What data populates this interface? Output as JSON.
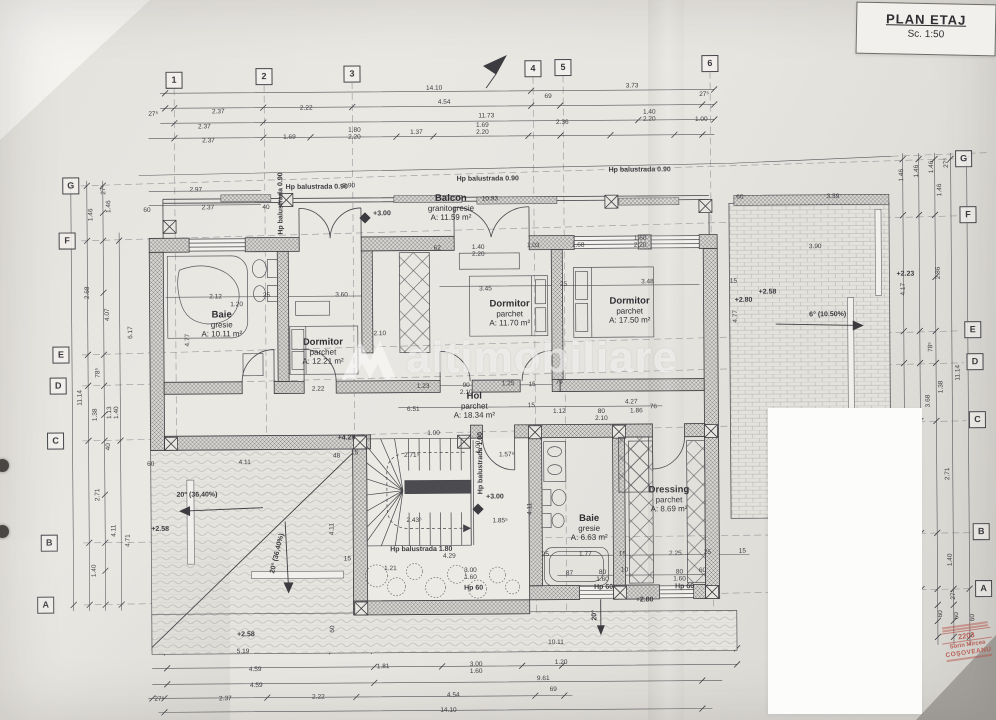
{
  "meta": {
    "title": "PLAN ETAJ",
    "scale": "Sc. 1:50"
  },
  "watermark": {
    "text": "altimobiliare"
  },
  "stamp": {
    "number": "2203",
    "name_line1": "Sorin Mircea",
    "name_line2": "COŞOVEANU"
  },
  "grid": {
    "top": [
      {
        "label": "1",
        "x": 176,
        "y": 78
      },
      {
        "label": "2",
        "x": 266,
        "y": 75
      },
      {
        "label": "3",
        "x": 354,
        "y": 73
      },
      {
        "label": "4",
        "x": 535,
        "y": 69
      },
      {
        "label": "5",
        "x": 565,
        "y": 68
      },
      {
        "label": "6",
        "x": 712,
        "y": 65
      }
    ],
    "left": [
      {
        "label": "G",
        "x": 72,
        "y": 183
      },
      {
        "label": "F",
        "x": 68,
        "y": 238
      },
      {
        "label": "E",
        "x": 61,
        "y": 352
      },
      {
        "label": "D",
        "x": 58,
        "y": 383
      },
      {
        "label": "C",
        "x": 55,
        "y": 438
      },
      {
        "label": "B",
        "x": 48,
        "y": 540
      },
      {
        "label": "A",
        "x": 44,
        "y": 602
      }
    ],
    "right": [
      {
        "label": "G",
        "x": 965,
        "y": 162
      },
      {
        "label": "F",
        "x": 969,
        "y": 218
      },
      {
        "label": "E",
        "x": 973,
        "y": 333
      },
      {
        "label": "D",
        "x": 975,
        "y": 365
      },
      {
        "label": "C",
        "x": 977,
        "y": 423
      },
      {
        "label": "B",
        "x": 980,
        "y": 535
      },
      {
        "label": "A",
        "x": 982,
        "y": 592
      }
    ]
  },
  "rooms": [
    {
      "name": "Baie",
      "finish": "gresie",
      "area": "A: 10.11 m²",
      "x": 222,
      "y": 322
    },
    {
      "name": "Dormitor",
      "finish": "parchet",
      "area": "A: 12.21 m²",
      "x": 323,
      "y": 350
    },
    {
      "name": "Dormitor",
      "finish": "parchet",
      "area": "A: 11.70 m²",
      "x": 510,
      "y": 313
    },
    {
      "name": "Dormitor",
      "finish": "parchet",
      "area": "A: 17.50 m²",
      "x": 630,
      "y": 311
    },
    {
      "name": "Balcon",
      "finish": "granitogresie",
      "area": "A: 11.59 m²",
      "x": 452,
      "y": 207
    },
    {
      "name": "Hol",
      "finish": "parchet",
      "area": "A: 18.34 m²",
      "x": 474,
      "y": 405
    },
    {
      "name": "Baie",
      "finish": "gresie",
      "area": "A: 6.63 m²",
      "x": 588,
      "y": 528
    },
    {
      "name": "Dressing",
      "finish": "parchet",
      "area": "A: 8.69 m²",
      "x": 668,
      "y": 500
    }
  ],
  "annotations": [
    {
      "t": "+3.00",
      "x": 383,
      "y": 213
    },
    {
      "t": "+3.00",
      "x": 494,
      "y": 497
    },
    {
      "t": "+2.80",
      "x": 643,
      "y": 601
    },
    {
      "t": "+2.58",
      "x": 768,
      "y": 294
    },
    {
      "t": "+2.80",
      "x": 744,
      "y": 302
    },
    {
      "t": "+2.23",
      "x": 906,
      "y": 277
    },
    {
      "t": "+2.58",
      "x": 159,
      "y": 527
    },
    {
      "t": "+4.29",
      "x": 346,
      "y": 437
    },
    {
      "t": "+2.58",
      "x": 244,
      "y": 633
    },
    {
      "t": "20° (36,40%)",
      "x": 196,
      "y": 493
    },
    {
      "t": "20° (36,40%)",
      "x": 276,
      "y": 552,
      "r": -76
    },
    {
      "t": "6° (10.50%)",
      "x": 828,
      "y": 317
    },
    {
      "t": "20°",
      "x": 593,
      "y": 616,
      "r": -90
    },
    {
      "t": "Hp balustrada 0.90",
      "x": 318,
      "y": 186
    },
    {
      "t": "Hp balustrada 0.90",
      "x": 489,
      "y": 179
    },
    {
      "t": "Hp balustrada 0.90",
      "x": 641,
      "y": 171
    },
    {
      "t": "Hp balustrada 0.90",
      "x": 282,
      "y": 202,
      "r": -90
    },
    {
      "t": "Hp balustrada 1.80",
      "x": 420,
      "y": 549
    },
    {
      "t": "Hp balustrada 1.00",
      "x": 480,
      "y": 463,
      "r": -90
    },
    {
      "t": "Hp 60",
      "x": 472,
      "y": 588
    },
    {
      "t": "Hp 60",
      "x": 602,
      "y": 588
    },
    {
      "t": "Hp 60",
      "x": 683,
      "y": 588
    }
  ],
  "dimensions": [
    {
      "t": "27⁵",
      "x": 155,
      "y": 112
    },
    {
      "t": "2.37",
      "x": 220,
      "y": 110
    },
    {
      "t": "2.22",
      "x": 308,
      "y": 107
    },
    {
      "t": "14.10",
      "x": 436,
      "y": 88
    },
    {
      "t": "4.54",
      "x": 446,
      "y": 102
    },
    {
      "t": "11.73",
      "x": 488,
      "y": 116
    },
    {
      "t": "2.37",
      "x": 206,
      "y": 125
    },
    {
      "t": "2.37",
      "x": 210,
      "y": 139
    },
    {
      "t": "1.69",
      "x": 291,
      "y": 136
    },
    {
      "t": "1.80|2.20",
      "x": 356,
      "y": 133
    },
    {
      "t": "1.37",
      "x": 418,
      "y": 132
    },
    {
      "t": "1.69|2.20",
      "x": 484,
      "y": 129
    },
    {
      "t": "69",
      "x": 550,
      "y": 97
    },
    {
      "t": "3.73",
      "x": 634,
      "y": 87
    },
    {
      "t": "27⁵",
      "x": 706,
      "y": 96
    },
    {
      "t": "2.36",
      "x": 564,
      "y": 123
    },
    {
      "t": "1.40|2.20",
      "x": 651,
      "y": 117
    },
    {
      "t": "1.00",
      "x": 703,
      "y": 121
    },
    {
      "t": "2.97",
      "x": 197,
      "y": 188
    },
    {
      "t": "3.90",
      "x": 350,
      "y": 185
    },
    {
      "t": "2.37",
      "x": 209,
      "y": 206
    },
    {
      "t": "60",
      "x": 148,
      "y": 208
    },
    {
      "t": "40",
      "x": 267,
      "y": 206
    },
    {
      "t": "10.93",
      "x": 491,
      "y": 199
    },
    {
      "t": "62",
      "x": 438,
      "y": 248
    },
    {
      "t": "1.40|2.20",
      "x": 479,
      "y": 251
    },
    {
      "t": "1.03",
      "x": 534,
      "y": 246
    },
    {
      "t": "1.68",
      "x": 579,
      "y": 246
    },
    {
      "t": "1.60|2.20",
      "x": 641,
      "y": 243
    },
    {
      "t": "2.12",
      "x": 216,
      "y": 295
    },
    {
      "t": "25",
      "x": 267,
      "y": 294
    },
    {
      "t": "3.60",
      "x": 342,
      "y": 294
    },
    {
      "t": "1.20",
      "x": 237,
      "y": 303
    },
    {
      "t": "3.45",
      "x": 486,
      "y": 289
    },
    {
      "t": "25",
      "x": 564,
      "y": 285
    },
    {
      "t": "3.48",
      "x": 648,
      "y": 283
    },
    {
      "t": "4.77",
      "x": 188,
      "y": 338,
      "r": -90
    },
    {
      "t": "4.77",
      "x": 736,
      "y": 318,
      "r": -90
    },
    {
      "t": "3.39",
      "x": 834,
      "y": 199
    },
    {
      "t": "60",
      "x": 741,
      "y": 199
    },
    {
      "t": "3.90",
      "x": 816,
      "y": 249
    },
    {
      "t": "15",
      "x": 734,
      "y": 283
    },
    {
      "t": "4.17",
      "x": 904,
      "y": 292,
      "r": -90
    },
    {
      "t": "2.22",
      "x": 318,
      "y": 388
    },
    {
      "t": "2.10",
      "x": 380,
      "y": 333
    },
    {
      "t": "1.23",
      "x": 423,
      "y": 386
    },
    {
      "t": "90|2.10",
      "x": 466,
      "y": 389
    },
    {
      "t": "1.25",
      "x": 508,
      "y": 384
    },
    {
      "t": "15",
      "x": 532,
      "y": 385
    },
    {
      "t": "79",
      "x": 559,
      "y": 383
    },
    {
      "t": "6.51",
      "x": 413,
      "y": 409
    },
    {
      "t": "15",
      "x": 531,
      "y": 406
    },
    {
      "t": "1.12",
      "x": 559,
      "y": 412
    },
    {
      "t": "80|2.10",
      "x": 601,
      "y": 416
    },
    {
      "t": "4.27",
      "x": 631,
      "y": 403
    },
    {
      "t": "1.86",
      "x": 636,
      "y": 412
    },
    {
      "t": "76",
      "x": 653,
      "y": 408
    },
    {
      "t": "1.00",
      "x": 433,
      "y": 433
    },
    {
      "t": "2.71⁵",
      "x": 411,
      "y": 455
    },
    {
      "t": "1.57⁵",
      "x": 506,
      "y": 455
    },
    {
      "t": "1.00",
      "x": 478,
      "y": 447,
      "r": -90
    },
    {
      "t": "2.43⁵",
      "x": 413,
      "y": 520
    },
    {
      "t": "1.85⁵",
      "x": 499,
      "y": 521
    },
    {
      "t": "4.11",
      "x": 529,
      "y": 509,
      "r": -90
    },
    {
      "t": "4.29",
      "x": 448,
      "y": 556
    },
    {
      "t": "1.21",
      "x": 389,
      "y": 568
    },
    {
      "t": "3.00|1.60",
      "x": 469,
      "y": 574
    },
    {
      "t": "60",
      "x": 150,
      "y": 462
    },
    {
      "t": "4.11",
      "x": 244,
      "y": 461
    },
    {
      "t": "48",
      "x": 336,
      "y": 455
    },
    {
      "t": "15",
      "x": 354,
      "y": 452
    },
    {
      "t": "4.11",
      "x": 331,
      "y": 528,
      "r": -90
    },
    {
      "t": "60",
      "x": 331,
      "y": 628,
      "r": -90
    },
    {
      "t": "15",
      "x": 346,
      "y": 558
    },
    {
      "t": "25",
      "x": 544,
      "y": 555
    },
    {
      "t": "1.77",
      "x": 584,
      "y": 555
    },
    {
      "t": "15",
      "x": 621,
      "y": 555
    },
    {
      "t": "2.25",
      "x": 674,
      "y": 555
    },
    {
      "t": "25",
      "x": 706,
      "y": 554
    },
    {
      "t": "15",
      "x": 741,
      "y": 553
    },
    {
      "t": "87",
      "x": 568,
      "y": 574
    },
    {
      "t": "80|1.60",
      "x": 601,
      "y": 577
    },
    {
      "t": "10",
      "x": 623,
      "y": 571
    },
    {
      "t": "80|1.60",
      "x": 678,
      "y": 577
    },
    {
      "t": "60",
      "x": 701,
      "y": 572
    },
    {
      "t": "5.19",
      "x": 241,
      "y": 650
    },
    {
      "t": "10.11",
      "x": 554,
      "y": 643
    },
    {
      "t": "4.59",
      "x": 253,
      "y": 668
    },
    {
      "t": "1.81",
      "x": 381,
      "y": 666
    },
    {
      "t": "3.00|1.60",
      "x": 474,
      "y": 668
    },
    {
      "t": "1.20",
      "x": 559,
      "y": 663
    },
    {
      "t": "4.59",
      "x": 254,
      "y": 684
    },
    {
      "t": "9.61",
      "x": 541,
      "y": 679
    },
    {
      "t": "27⁵",
      "x": 157,
      "y": 697
    },
    {
      "t": "2.37",
      "x": 223,
      "y": 697
    },
    {
      "t": "2.22",
      "x": 316,
      "y": 696
    },
    {
      "t": "4.54",
      "x": 451,
      "y": 695
    },
    {
      "t": "69",
      "x": 551,
      "y": 690
    },
    {
      "t": "14.10",
      "x": 446,
      "y": 710
    },
    {
      "t": "27⁵",
      "x": 105,
      "y": 187,
      "r": -90
    },
    {
      "t": "1.46",
      "x": 92,
      "y": 212,
      "r": -90
    },
    {
      "t": "1.46",
      "x": 110,
      "y": 204,
      "r": -90
    },
    {
      "t": "2.68",
      "x": 88,
      "y": 290,
      "r": -90
    },
    {
      "t": "4.07",
      "x": 108,
      "y": 312,
      "r": -90
    },
    {
      "t": "6.17",
      "x": 131,
      "y": 330,
      "r": -90
    },
    {
      "t": "78⁵",
      "x": 98,
      "y": 370,
      "r": -90
    },
    {
      "t": "11.14",
      "x": 80,
      "y": 395,
      "r": -90
    },
    {
      "t": "1.38",
      "x": 95,
      "y": 412,
      "r": -90
    },
    {
      "t": "1.13|1.40",
      "x": 113,
      "y": 410,
      "r": -90
    },
    {
      "t": "40",
      "x": 108,
      "y": 444,
      "r": -90
    },
    {
      "t": "2.71",
      "x": 97,
      "y": 492,
      "r": -90
    },
    {
      "t": "4.11",
      "x": 113,
      "y": 528,
      "r": -90
    },
    {
      "t": "4.71",
      "x": 127,
      "y": 538,
      "r": -90
    },
    {
      "t": "1.40",
      "x": 93,
      "y": 568,
      "r": -90
    },
    {
      "t": "1.46",
      "x": 903,
      "y": 178,
      "r": -90
    },
    {
      "t": "1.46",
      "x": 918,
      "y": 174,
      "r": -90
    },
    {
      "t": "1.46",
      "x": 933,
      "y": 170,
      "r": -90
    },
    {
      "t": "27⁵",
      "x": 948,
      "y": 166,
      "r": -90
    },
    {
      "t": "1.46",
      "x": 941,
      "y": 193,
      "r": -90
    },
    {
      "t": "2.86",
      "x": 939,
      "y": 276,
      "r": -90
    },
    {
      "t": "78⁵",
      "x": 931,
      "y": 350,
      "r": -90
    },
    {
      "t": "1.38",
      "x": 941,
      "y": 390,
      "r": -90
    },
    {
      "t": "11.14",
      "x": 958,
      "y": 376,
      "r": -90
    },
    {
      "t": "3.68",
      "x": 928,
      "y": 404,
      "r": -90
    },
    {
      "t": "2.71",
      "x": 947,
      "y": 477,
      "r": -90
    },
    {
      "t": "1.40",
      "x": 949,
      "y": 563,
      "r": -90
    },
    {
      "t": "27⁵",
      "x": 952,
      "y": 598,
      "r": -90
    },
    {
      "t": "60",
      "x": 939,
      "y": 617,
      "r": -90
    },
    {
      "t": "60",
      "x": 955,
      "y": 619,
      "r": -90
    },
    {
      "t": "60",
      "x": 971,
      "y": 621,
      "r": -90
    }
  ]
}
